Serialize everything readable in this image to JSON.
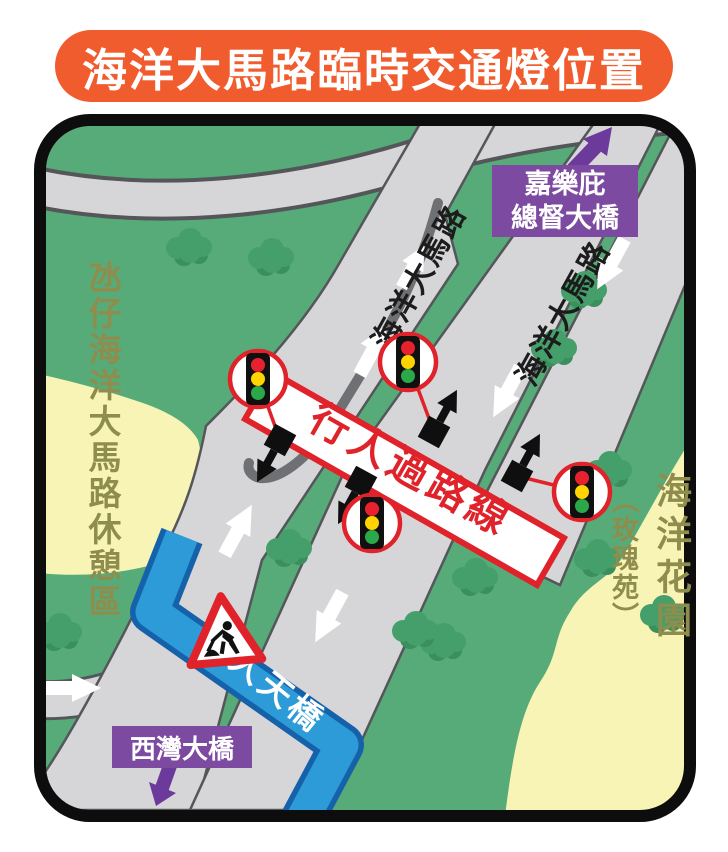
{
  "banner": {
    "title": "海洋大馬路臨時交通燈位置"
  },
  "map": {
    "side_labels": {
      "west": "氹仔海洋大馬路休憩區",
      "east_main": "海洋花園",
      "east_sub": "（玫瑰苑）"
    },
    "road_labels": [
      "海洋大馬路",
      "海洋大馬路"
    ],
    "destinations": {
      "north_line1": "嘉樂庇",
      "north_line2": "總督大橋",
      "south": "西灣大橋"
    },
    "crossing_label": "行人過路線",
    "footbridge_label": "行人天橋",
    "traffic_light_count": 4,
    "icons": {
      "traffic_light": "traffic-light-icon",
      "signal_pole": "signal-pole-icon",
      "roadworks": "roadworks-sign-icon",
      "flow_arrow": "traffic-flow-arrow-icon"
    },
    "colors": {
      "banner_orange": "#F15C2E",
      "map_border": "#0D0D0D",
      "cream": "#F7F4B5",
      "park_green": "#57AB79",
      "bush_green": "#459F6A",
      "bush_dark": "#3B8F5D",
      "road_gray": "#D6D6D8",
      "road_edge": "#54565A",
      "median_gray": "#6F7073",
      "crossing_red": "#E0222A",
      "signal_red": "#E8212E",
      "signal_yellow": "#FFD400",
      "signal_green": "#2BA84A",
      "footbridge_blue": "#2E9BD9",
      "footbridge_edge": "#1562AA",
      "purple": "#7C4AA0",
      "purple_arrow": "#6B3A9A",
      "olive_text": "#8F8D4E"
    }
  }
}
